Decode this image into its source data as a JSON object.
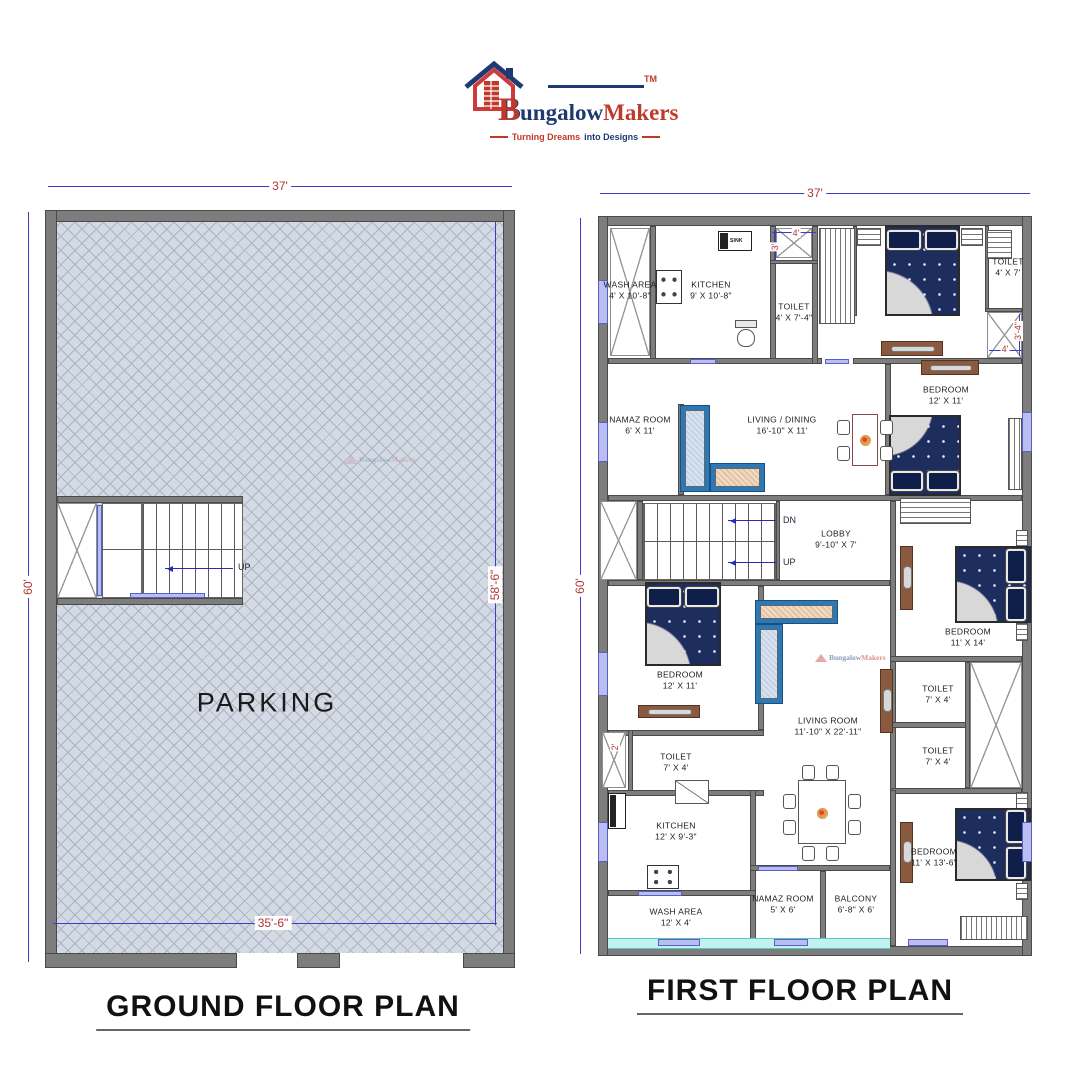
{
  "logo": {
    "brand_b": "B",
    "brand_rest": "ungalow",
    "brand_makers": "Makers",
    "trademark": "TM",
    "tagline_red": "Turning Dreams",
    "tagline_blue": "into Designs"
  },
  "ground_floor": {
    "title": "GROUND FLOOR PLAN",
    "parking": "PARKING",
    "up": "UP",
    "dim_top": "37'",
    "dim_left": "60'",
    "dim_right_inner": "58'-6\"",
    "dim_bottom_inner": "35'-6\""
  },
  "first_floor": {
    "title": "FIRST FLOOR PLAN",
    "dim_top": "37'",
    "dim_left": "60'",
    "dn": "DN",
    "up": "UP",
    "sink": "SINK",
    "small_dims": {
      "shaft_top_w": "4'",
      "shaft_top_h": "3'",
      "shaft_right_w": "4'",
      "shaft_right_h": "3'-4\"",
      "toilet_entry": "2'"
    },
    "rooms": [
      {
        "name": "WASH AREA",
        "size": "4' X 10'-8\""
      },
      {
        "name": "KITCHEN",
        "size": "9' X 10'-8\""
      },
      {
        "name": "TOILET",
        "size": "4' X 7'-4\""
      },
      {
        "name": "TOILET",
        "size": "4' X 7'"
      },
      {
        "name": "BEDROOM",
        "size": "12' X 11'"
      },
      {
        "name": "NAMAZ ROOM",
        "size": "6' X 11'"
      },
      {
        "name": "LIVING / DINING",
        "size": "16'-10\" X 11'"
      },
      {
        "name": "LOBBY",
        "size": "9'-10\" X 7'"
      },
      {
        "name": "BEDROOM",
        "size": "12' X 11'"
      },
      {
        "name": "BEDROOM",
        "size": "11' X 14'"
      },
      {
        "name": "TOILET",
        "size": "7' X 4'"
      },
      {
        "name": "TOILET",
        "size": "7' X 4'"
      },
      {
        "name": "TOILET",
        "size": "7' X 4'"
      },
      {
        "name": "LIVING ROOM",
        "size": "11'-10\" X 22'-11\""
      },
      {
        "name": "KITCHEN",
        "size": "12' X 9'-3\""
      },
      {
        "name": "WASH AREA",
        "size": "12' X 4'"
      },
      {
        "name": "NAMAZ ROOM",
        "size": "5' X 6'"
      },
      {
        "name": "BALCONY",
        "size": "6'-8\" X 6'"
      },
      {
        "name": "BEDROOM",
        "size": "11' X 13'-6\""
      }
    ]
  }
}
